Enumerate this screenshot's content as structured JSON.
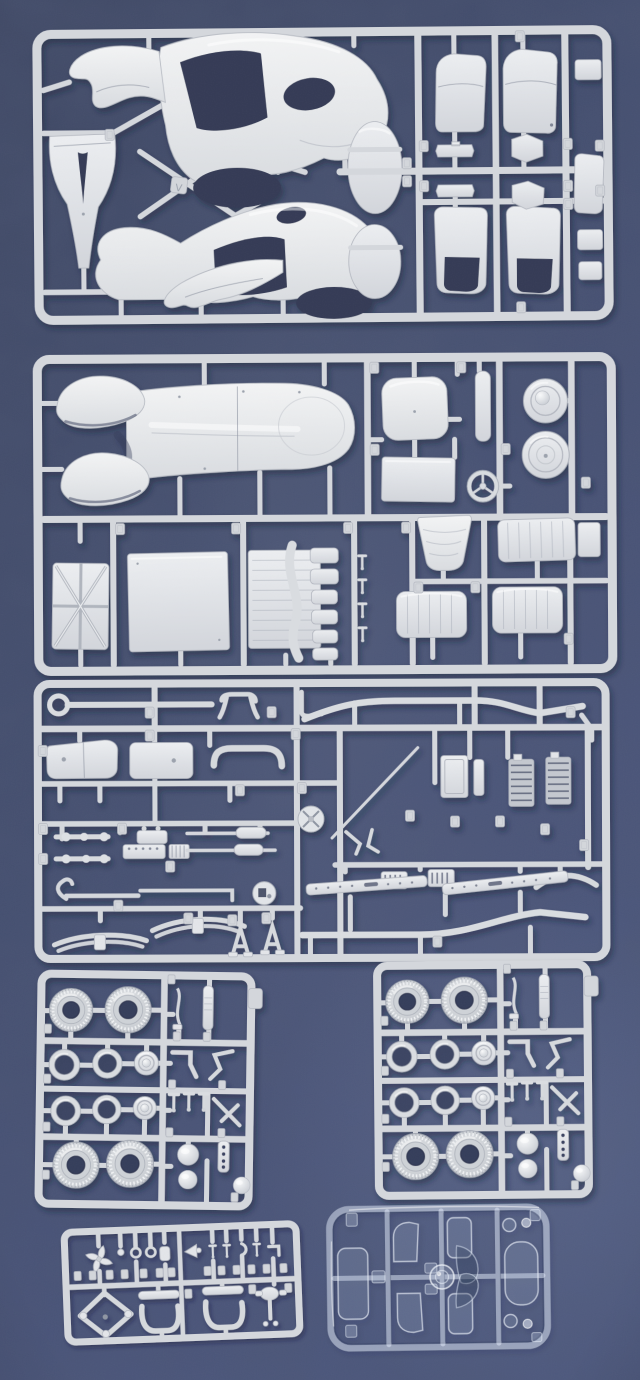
{
  "scene": {
    "type": "photograph",
    "subject": "Unbuilt plastic scale-model car kit: six light-grey injection sprues and one clear sprue laid out on a dark blue textured surface",
    "background_color": "#414d74",
    "background_dark": "#39425e",
    "background_light": "#4a567e",
    "plastic_color": "#d6d9dc",
    "plastic_highlight": "#eef0f3",
    "clear_sprue_tint": "#dfe9fa",
    "shadow_color": "#161e38",
    "sprue_letter_tag": "V"
  },
  "sprues": [
    {
      "id": "body-sprue",
      "position": "top",
      "label": "Large sprue with two car body side shells, bonnet panel, two oval panels and four doors"
    },
    {
      "id": "floor-sprue",
      "position": "upper-middle",
      "label": "Sprue with floor pan and front fenders, seat back, panels, steering wheel, wheel discs, louvered panel, tunnel cover and pleated bench seats"
    },
    {
      "id": "chassis-sprue",
      "position": "middle",
      "label": "Dense sprue of chassis rails, riveted sills, leaf springs, axles, exhausts, engine halves, radiator and many small fittings"
    },
    {
      "id": "wheel-sprue-left",
      "position": "lower-left",
      "label": "Sprue with four treaded tyres, six wheel rims, hub domes, shock absorber and suspension details"
    },
    {
      "id": "wheel-sprue-right",
      "position": "lower-right",
      "label": "Identical duplicate sprue with four treaded tyres, six wheel rims, hub domes and suspension details"
    },
    {
      "id": "fittings-sprue",
      "position": "bottom-left",
      "label": "Small sprue with cooling fan, knobs, horn, bumper brackets and diamond spare-wheel frame"
    },
    {
      "id": "clear-sprue",
      "position": "bottom-right",
      "label": "Transparent sprue with windscreen, door windows, quarter windows, rear window and headlamp lenses"
    }
  ]
}
